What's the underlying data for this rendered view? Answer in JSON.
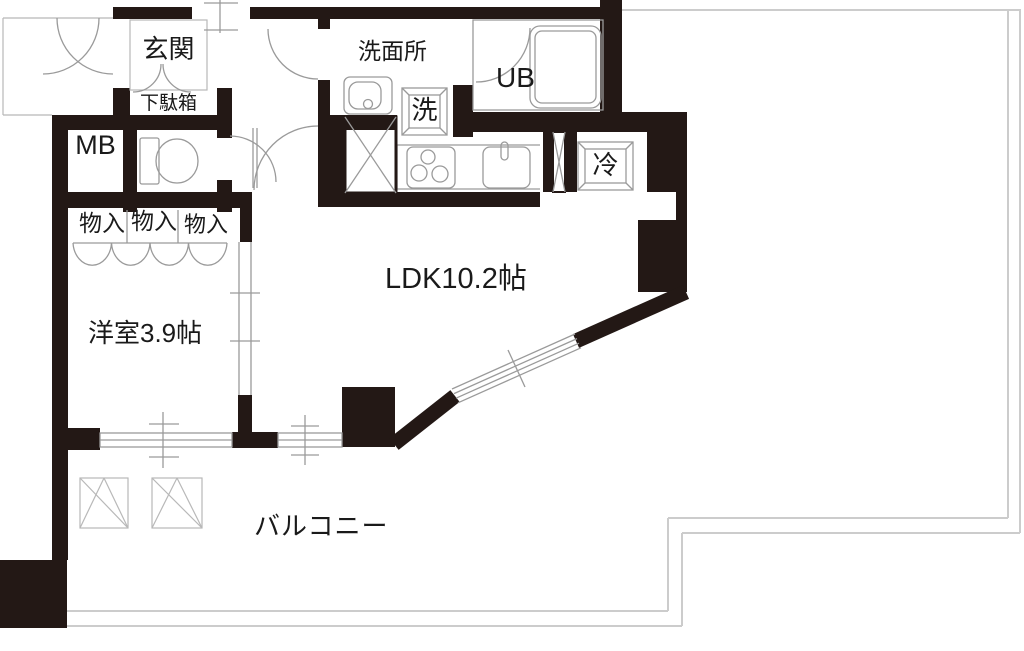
{
  "plan_title": "1K/1LDK apartment floor plan",
  "colors": {
    "wall": "#231815",
    "line": "#9a9a9a",
    "line2": "#b8b8b8",
    "balcony": "#cccccc",
    "text": "#1a1a1a",
    "bg": "#ffffff"
  },
  "rooms": {
    "entrance": "玄関",
    "shoe_cabinet": "下駄箱",
    "meter_box": "MB",
    "storage_1": "物入",
    "storage_2": "物入",
    "storage_3": "物入",
    "washroom": "洗面所",
    "washer": "洗",
    "unit_bath": "UB",
    "refrigerator": "冷",
    "ldk": "LDK10.2帖",
    "western_room": "洋室3.9帖",
    "balcony": "バルコニー"
  }
}
